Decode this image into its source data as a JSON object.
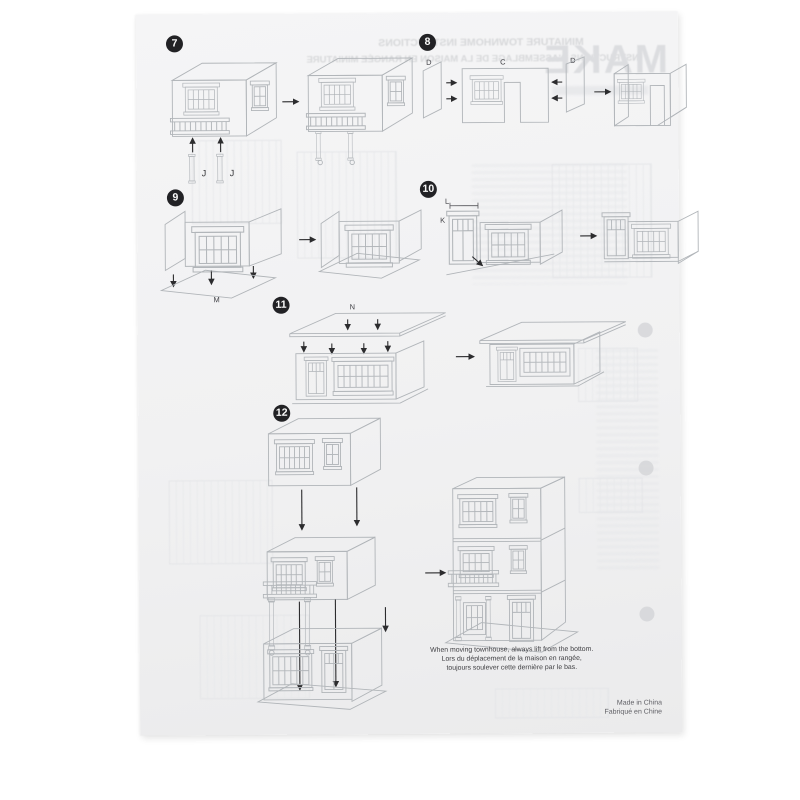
{
  "sheet": {
    "ghost": {
      "brand": "MAKE",
      "title_en": "MINIATURE TOWNHOME INSTRUCTIONS",
      "title_fr": "INSTRUCTIONS D'ASSEMBLAGE DE LA MAISON EN RANGÉE MINIATURE"
    },
    "steps": [
      {
        "number": "7",
        "labels": {
          "j1": "J",
          "j2": "J"
        }
      },
      {
        "number": "8",
        "labels": {
          "d_left": "D",
          "c": "C",
          "d_right": "D"
        }
      },
      {
        "number": "9",
        "labels": {
          "m": "M"
        }
      },
      {
        "number": "10",
        "labels": {
          "l": "L",
          "k": "K"
        }
      },
      {
        "number": "11",
        "labels": {
          "n": "N"
        }
      },
      {
        "number": "12",
        "labels": {}
      }
    ],
    "caption": {
      "line1": "When moving townhouse, always lift from the bottom.",
      "line2": "Lors du déplacement de la maison en rangée,",
      "line3": "toujours soulever cette dernière par le bas."
    },
    "footer": {
      "line1": "Made in China",
      "line2": "Fabriqué en Chine"
    }
  }
}
